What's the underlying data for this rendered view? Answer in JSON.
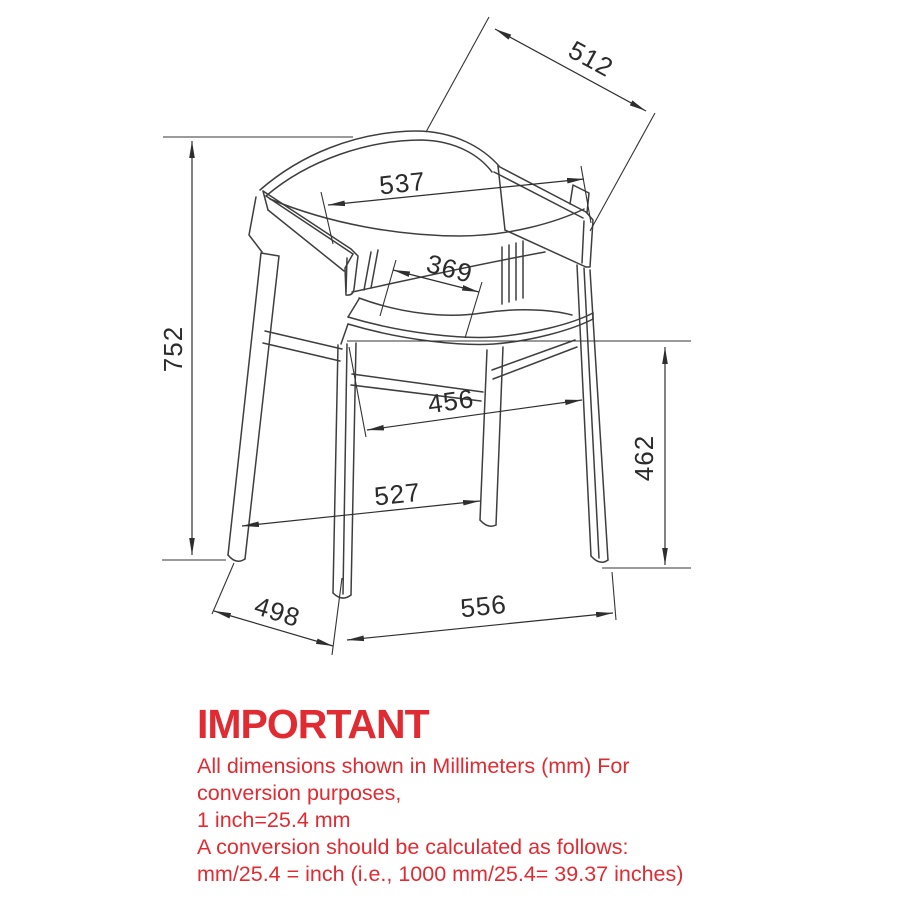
{
  "diagram": {
    "type": "technical-drawing",
    "subject": "Armchair three-quarter line drawing with dimension annotations",
    "units": "mm",
    "dimensions_mm": {
      "overall_height": "752",
      "backrest_top_diagonal": "512",
      "backrest_width": "537",
      "seat_depth_inner": "369",
      "seat_width_inner": "456",
      "seat_height": "462",
      "front_span": "527",
      "side_depth": "498",
      "overall_width": "556"
    },
    "line_color": "#3e3e3e"
  },
  "notice": {
    "heading": "IMPORTANT",
    "color": "#e12b33",
    "line1": "All dimensions shown in Millimeters (mm) For",
    "line2": "conversion purposes,",
    "line3": "1 inch=25.4 mm",
    "line4": "A conversion should be calculated as follows:",
    "line5": "mm/25.4 = inch (i.e., 1000 mm/25.4= 39.37 inches)"
  }
}
